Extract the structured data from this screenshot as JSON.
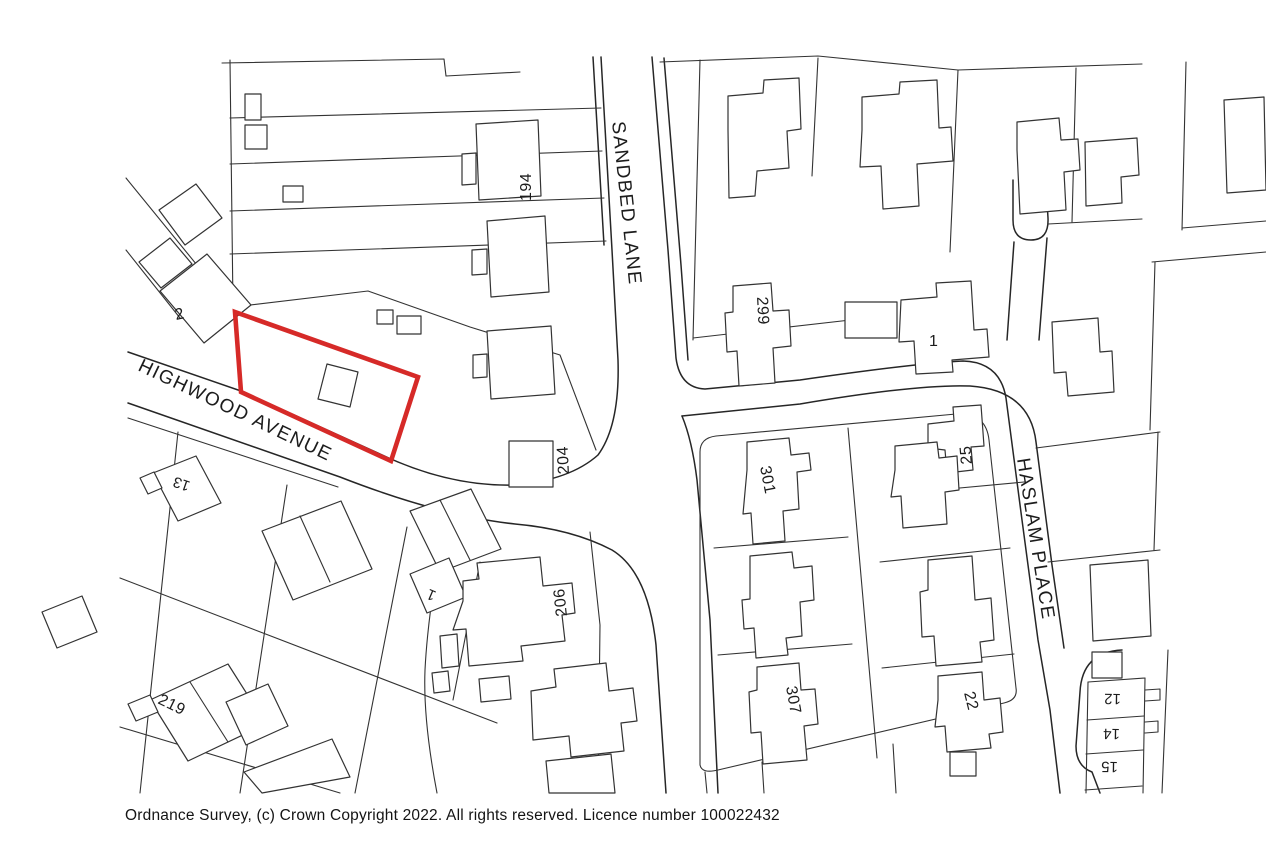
{
  "map": {
    "streets": {
      "sandbed_lane": "SANDBED LANE",
      "highwood_avenue": "HIGHWOOD AVENUE",
      "haslam_place": "HASLAM PLACE"
    },
    "house_numbers": {
      "n194": "194",
      "n2": "2",
      "n299": "299",
      "n1_east": "1",
      "n204": "204",
      "n25": "25",
      "n301": "301",
      "n206": "206",
      "n13": "13",
      "n1_south": "1",
      "n219": "219",
      "n307": "307",
      "n22": "22",
      "n12": "12",
      "n14": "14",
      "n15": "15"
    },
    "boundary_color": "#d62a28"
  },
  "footer": {
    "copyright": "Ordnance Survey, (c) Crown Copyright 2022. All rights reserved. Licence number 100022432"
  }
}
